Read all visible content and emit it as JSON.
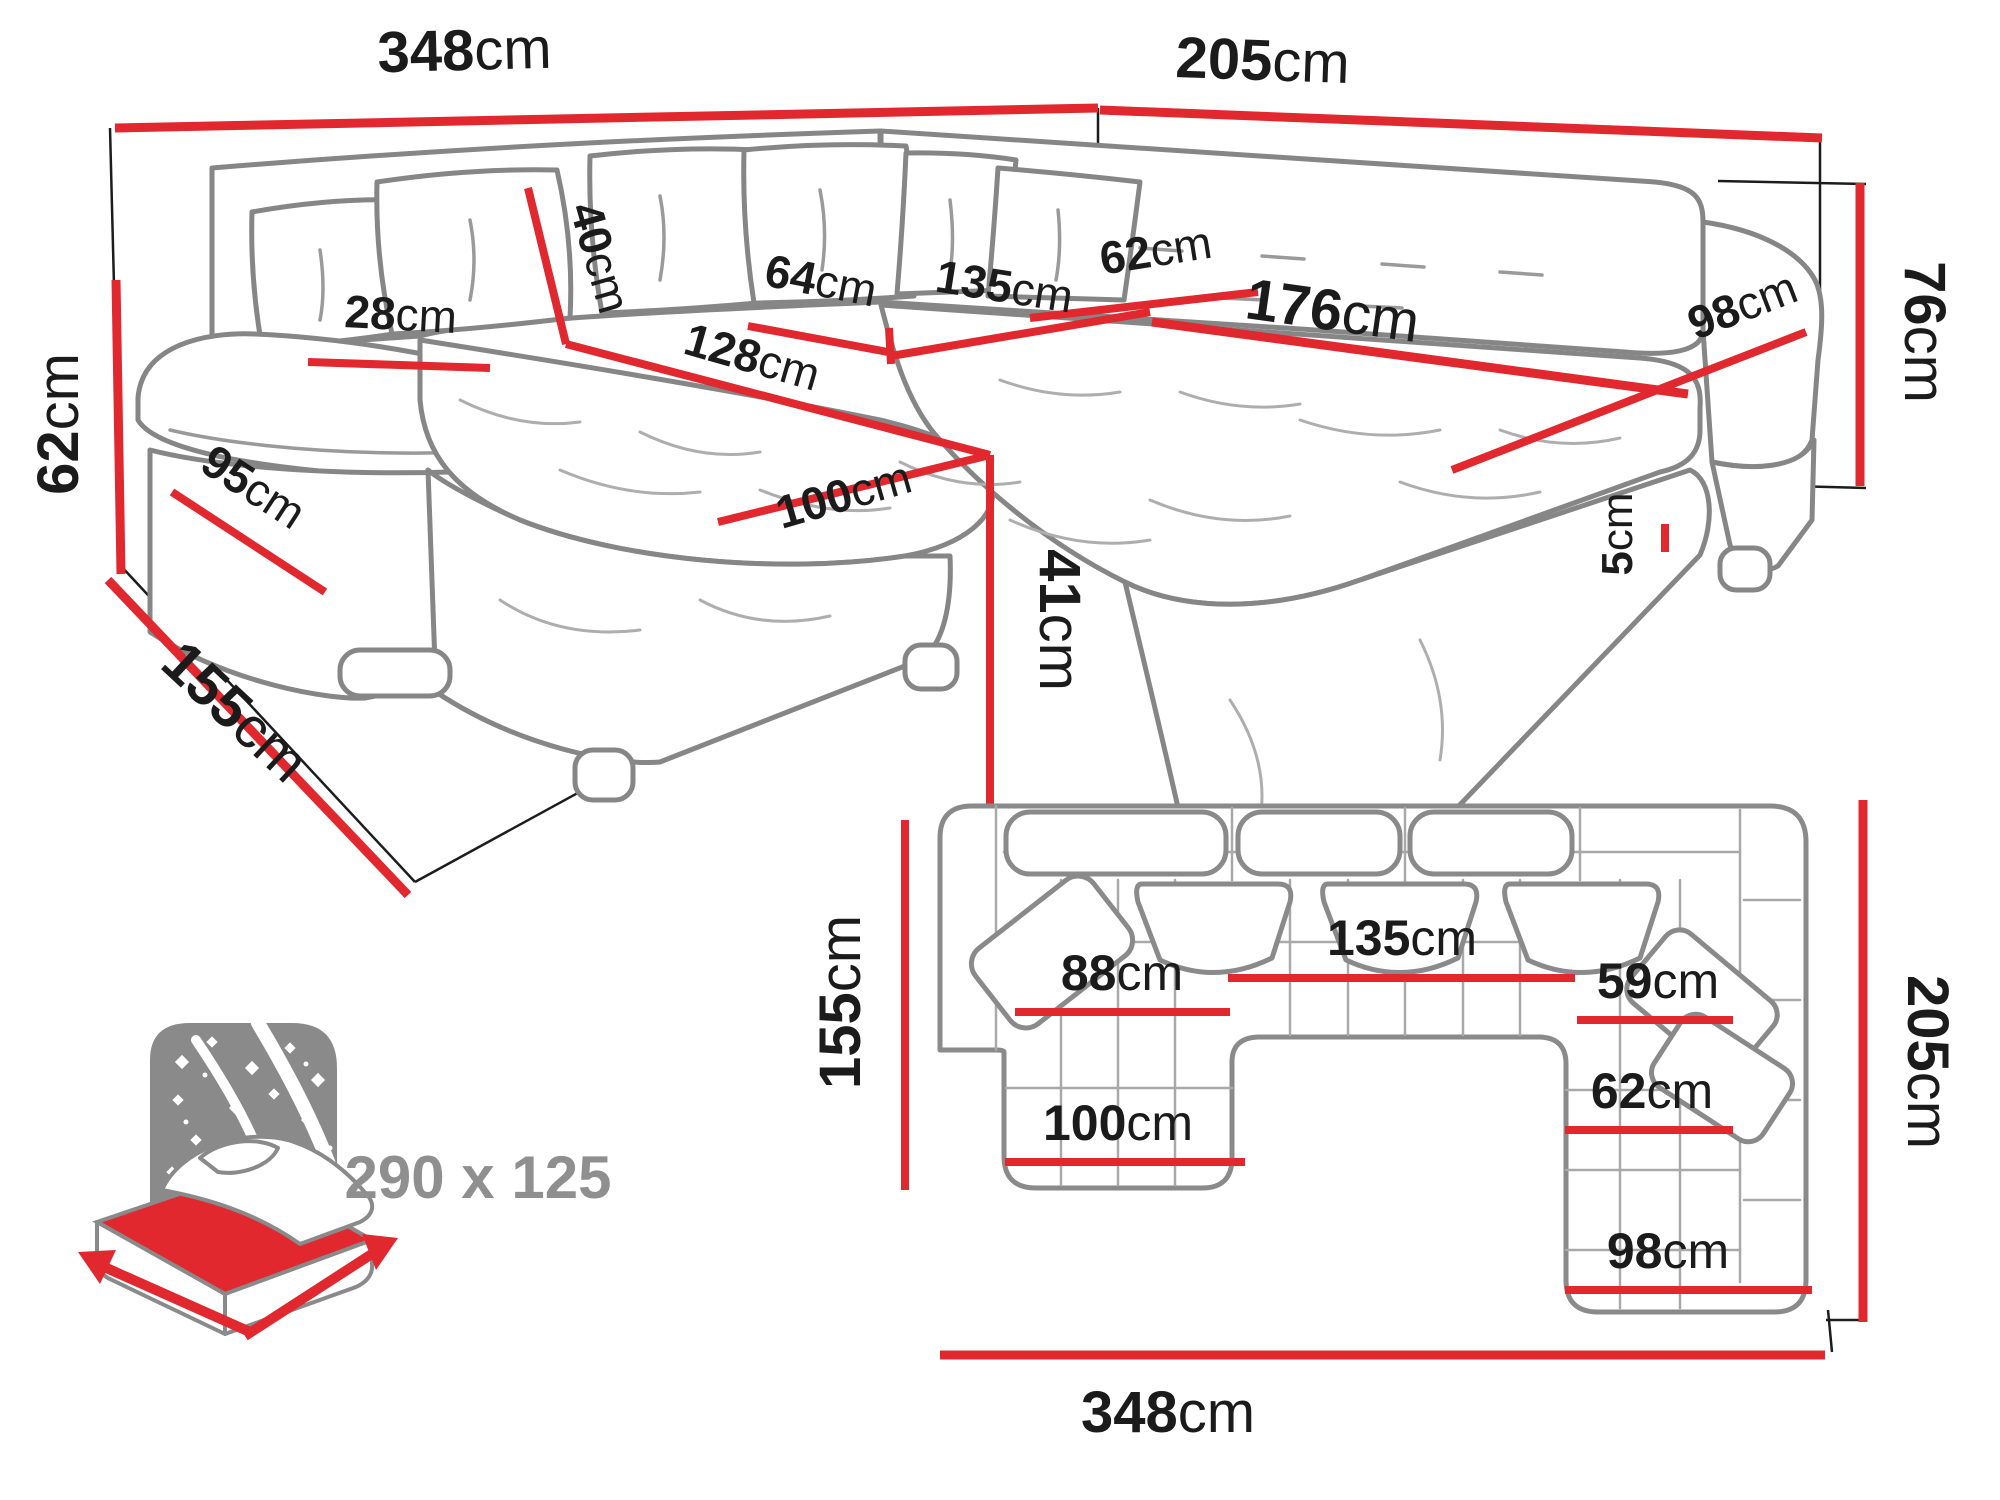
{
  "colors": {
    "dimension_red": "#e0282e",
    "sofa_outline_gray": "#868686",
    "label_black": "#1b1b1b",
    "sleeper_gray": "#8f8f8f"
  },
  "perspective_view": {
    "back_width": {
      "v": "348",
      "u": "cm"
    },
    "side_width": {
      "v": "205",
      "u": "cm"
    },
    "back_height": {
      "v": "76",
      "u": "cm"
    },
    "arm_height": {
      "v": "62",
      "u": "cm"
    },
    "chaise_total_depth": {
      "v": "155",
      "u": "cm"
    },
    "arm_front_length": {
      "v": "95",
      "u": "cm"
    },
    "armrest_width": {
      "v": "28",
      "u": "cm"
    },
    "back_cushion": {
      "v": "40",
      "u": "cm"
    },
    "chaise_length": {
      "v": "128",
      "u": "cm"
    },
    "seat_depth": {
      "v": "64",
      "u": "cm"
    },
    "seat_width": {
      "v": "135",
      "u": "cm"
    },
    "corner_seat": {
      "v": "62",
      "u": "cm"
    },
    "right_seat_width": {
      "v": "176",
      "u": "cm"
    },
    "right_seat_depth": {
      "v": "98",
      "u": "cm"
    },
    "chaise_width": {
      "v": "100",
      "u": "cm"
    },
    "seat_height": {
      "v": "41",
      "u": "cm"
    },
    "leg_height": {
      "v": "5",
      "u": "cm"
    }
  },
  "plan_view": {
    "left_depth": {
      "v": "155",
      "u": "cm"
    },
    "chaise_seat_width": {
      "v": "88",
      "u": "cm"
    },
    "mid_seat_width": {
      "v": "135",
      "u": "cm"
    },
    "corner_seat_width": {
      "v": "59",
      "u": "cm"
    },
    "right_seat_width": {
      "v": "62",
      "u": "cm"
    },
    "chaise_width": {
      "v": "100",
      "u": "cm"
    },
    "right_col_width": {
      "v": "98",
      "u": "cm"
    },
    "right_depth": {
      "v": "205",
      "u": "cm"
    },
    "total_width": {
      "v": "348",
      "u": "cm"
    }
  },
  "sleeper": {
    "size": "290 x 125"
  }
}
